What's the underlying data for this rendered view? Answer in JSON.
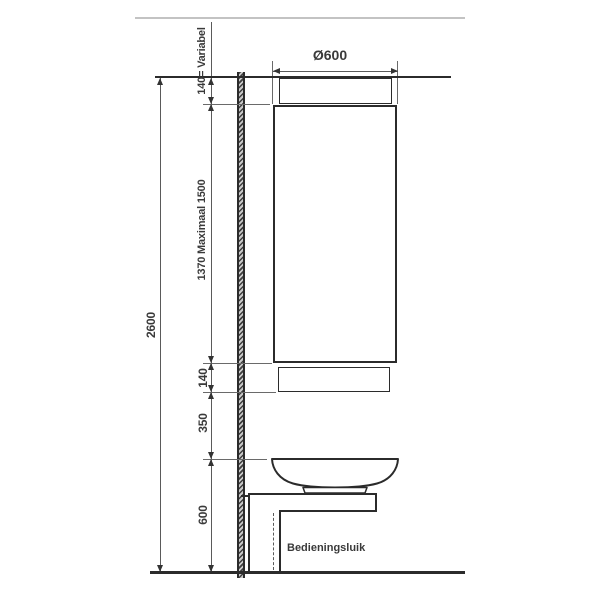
{
  "dimensions": {
    "total_height": "2600",
    "ceiling_gap": "140= Variabel",
    "unit_height": "1370 Maximaal 1500",
    "lower_gap": "140",
    "basin_clearance": "350",
    "worktop_height": "600",
    "unit_diameter": "Ø600"
  },
  "labels": {
    "access_panel": "Bedieningsluik"
  },
  "colors": {
    "drawing_line": "#2b2b2b",
    "dimension_line": "#5a5a5a",
    "faint_line": "#c3c3c3",
    "text": "#3a3a3a",
    "background": "#ffffff"
  }
}
